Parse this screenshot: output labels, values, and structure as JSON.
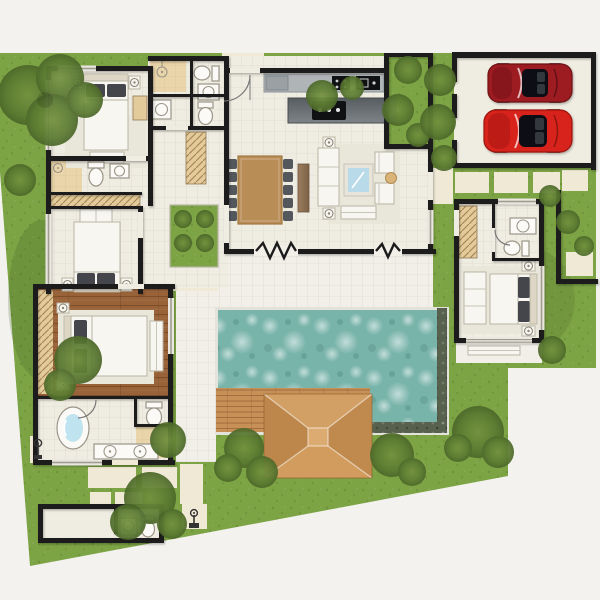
{
  "meta": {
    "type": "architectural-floor-plan",
    "view": "top-down",
    "visible_text": "none"
  },
  "labels": {
    "site": "landscaped-villa-plot",
    "lawn": "garden-lawn",
    "house": "villa-floor-plan",
    "bedroom1": "bedroom-one",
    "bedroom2": "bedroom-two",
    "master_bedroom": "master-bedroom-hardwood",
    "master_bathroom": "master-bathroom",
    "bathrooms": "shared-bathrooms",
    "kitchen": "kitchen",
    "dining": "dining-area",
    "living": "living-area",
    "guest_suite": "guest-suite",
    "garage": "two-car-garage",
    "pool": "swimming-pool",
    "deck": "timber-pool-deck",
    "sala": "sala-pavilion-roof",
    "terrace": "pool-terrace",
    "outbuilding": "storage-and-wc-outbuilding",
    "courtyard": "inner-planted-courtyard"
  },
  "colors": {
    "bg": "#f3f2ef",
    "lawn": "#7ca344",
    "lawn_shade": "#5f8034",
    "floor": "#efece1",
    "terrace": "#f1efe7",
    "path": "#efe9d6",
    "wall": "#1b1b1b",
    "wood": "#9a6238",
    "deck": "#c69057",
    "roof": "#cf9a5e",
    "roof_light": "#dcab72",
    "roof_dark": "#bd874b",
    "pool_water": "#79b4ab",
    "pool_stone": "#57614d",
    "pool_rim": "#e3e3dc",
    "tan": "#e9d5a9",
    "closet": "#e3cb9c",
    "white_furniture": "#f8f6f0",
    "furn_stroke": "#b9b4a4",
    "pillow": "#45464c",
    "rug": "#e9e6da",
    "table_wood": "#b98d56",
    "sideboard": "#8d7052",
    "chair": "#54575c",
    "counter": "#afb4b7",
    "island_dark": "#575d61",
    "island_light": "#7e8387",
    "appliance": "#101112",
    "glass": "#b9dbe9",
    "tub_water": "#bfe4ef"
  },
  "vehicles": [
    {
      "name": "convertible-sports-car-dark-red",
      "color": "#9c1b22"
    },
    {
      "name": "convertible-sports-car-bright-red",
      "color": "#d8231a"
    }
  ],
  "rooms": [
    {
      "name": "bedroom-one",
      "furniture": [
        "double-bed",
        "two-nightstand-lamps",
        "foot-bench",
        "rug",
        "dresser"
      ]
    },
    {
      "name": "ensuite-bathroom-one",
      "furniture": [
        "shower",
        "toilet",
        "washbasin"
      ]
    },
    {
      "name": "wardrobe-hall",
      "furniture": [
        "built-in-closet"
      ]
    },
    {
      "name": "bedroom-two",
      "furniture": [
        "double-bed",
        "two-nightstand-lamps",
        "loveseat"
      ]
    },
    {
      "name": "master-bedroom",
      "furniture": [
        "hardwood-floor",
        "double-bed",
        "built-in-wardrobe",
        "side-bench",
        "rug"
      ]
    },
    {
      "name": "master-bathroom",
      "furniture": [
        "oval-bathtub",
        "double-vanity",
        "wc",
        "outdoor-shower"
      ]
    },
    {
      "name": "shared-bathrooms",
      "furniture": [
        "shower",
        "two-toilets",
        "two-washbasins"
      ]
    },
    {
      "name": "kitchen",
      "furniture": [
        "wall-counter",
        "refrigerator",
        "sink",
        "island-cooktop"
      ]
    },
    {
      "name": "dining-area",
      "furniture": [
        "ten-seat-table",
        "sideboard"
      ]
    },
    {
      "name": "living-area",
      "furniture": [
        "sofa",
        "two-armchairs",
        "glass-coffee-table",
        "two-floor-lamps",
        "daybed",
        "round-side-table"
      ]
    },
    {
      "name": "guest-suite",
      "furniture": [
        "double-bed",
        "sofa",
        "wardrobe",
        "ensuite-bathroom",
        "private-terrace-bench"
      ]
    },
    {
      "name": "garage",
      "furniture": [
        "two-sports-cars"
      ]
    },
    {
      "name": "outbuilding",
      "furniture": [
        "storage-room",
        "wc",
        "washbasin"
      ]
    }
  ],
  "outdoor_features": [
    "swimming-pool",
    "timber-deck",
    "sala-pavilion",
    "pool-terrace",
    "stepping-stone-paths",
    "garden-courtyards",
    "trees-and-shrubs",
    "garden-lamp",
    "outdoor-shower"
  ]
}
